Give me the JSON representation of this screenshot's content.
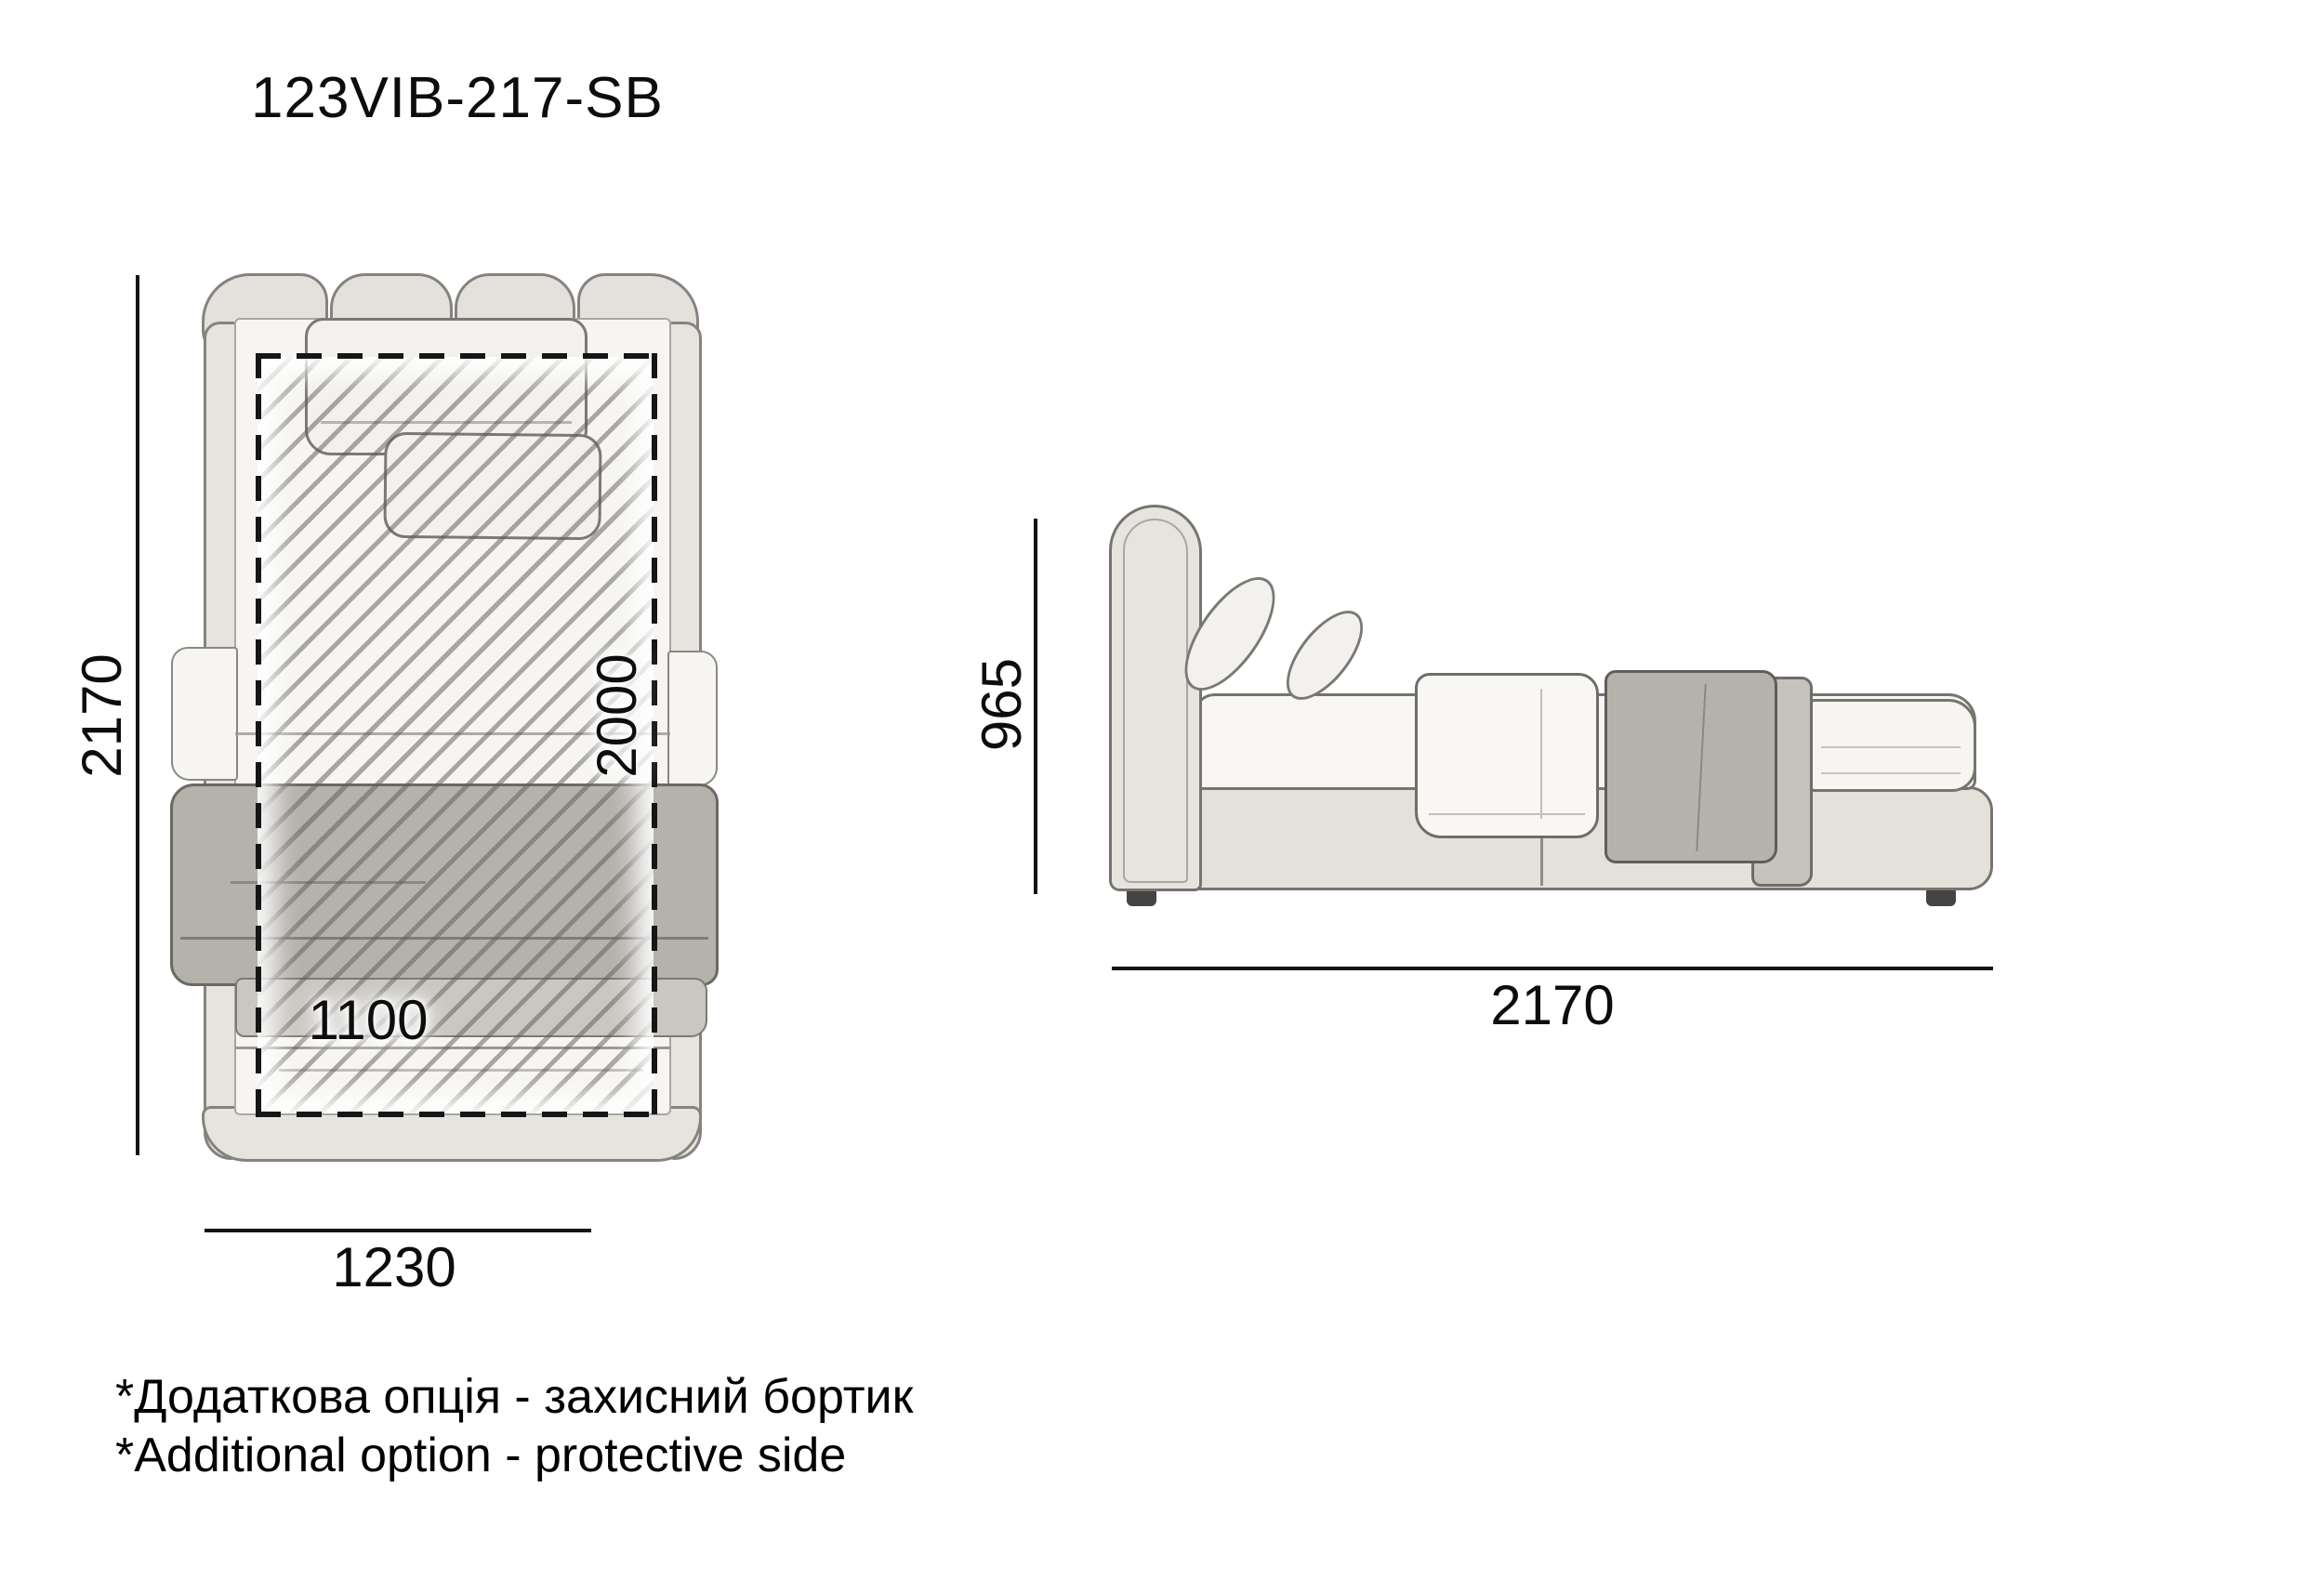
{
  "title": "123VIB-217-SB",
  "top_view": {
    "label": "bed top view",
    "overall_length_mm": "2170",
    "overall_width_mm": "1230",
    "mattress_length_mm": "2000",
    "mattress_width_mm": "1100"
  },
  "side_view": {
    "label": "bed side view",
    "height_mm": "965",
    "length_mm": "2170"
  },
  "notes": {
    "uk": "*Додаткова опція - захисний бортик",
    "en": "*Additional option - protective side"
  },
  "colors": {
    "fabric_light": "#e7e4df",
    "bedding_white": "#f6f5f2",
    "blanket_gray": "#b5b2ac",
    "outline_gray": "#76746f",
    "dimension_black": "#141414"
  }
}
